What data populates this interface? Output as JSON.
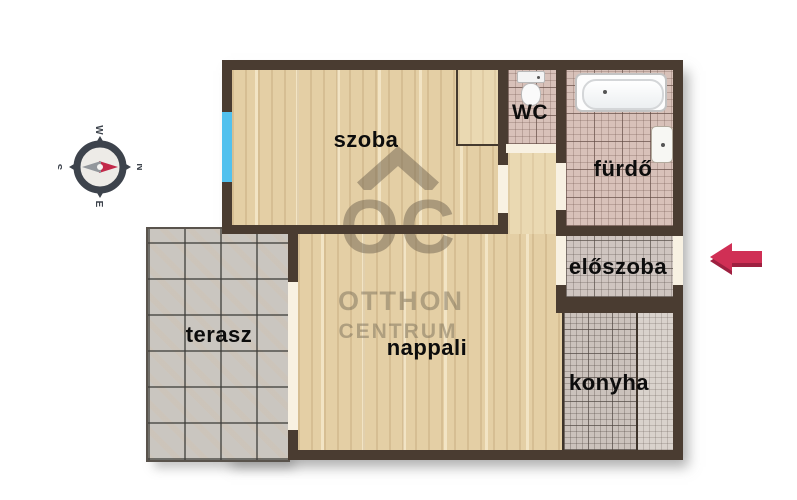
{
  "plan_title": "apartment-floorplan",
  "rooms": {
    "szoba": {
      "label": "szoba"
    },
    "wc": {
      "label": "WC"
    },
    "furdo": {
      "label": "fürdő"
    },
    "eloszoba": {
      "label": "előszoba"
    },
    "terasz": {
      "label": "terasz"
    },
    "nappali": {
      "label": "nappali"
    },
    "konyha": {
      "label": "konyha"
    }
  },
  "watermark": {
    "logo": "OC",
    "brand_line1": "OTTHON",
    "brand_line2": "CENTRUM"
  },
  "compass": {
    "n": "N",
    "e": "E",
    "s": "S",
    "w": "W",
    "orientation": "north-points-right"
  },
  "colors": {
    "wall": "#4a3c31",
    "wood_floor": "#e4cfa5",
    "bath_tile": "#d8c1b9",
    "hall_tile": "#cfc5c0",
    "kitchen_tile": "#cbc2bc",
    "terrace_tile": "#cac6c0",
    "window": "#52c1ee",
    "entrance_arrow": "#d02f55",
    "watermark": "#6f6451"
  }
}
